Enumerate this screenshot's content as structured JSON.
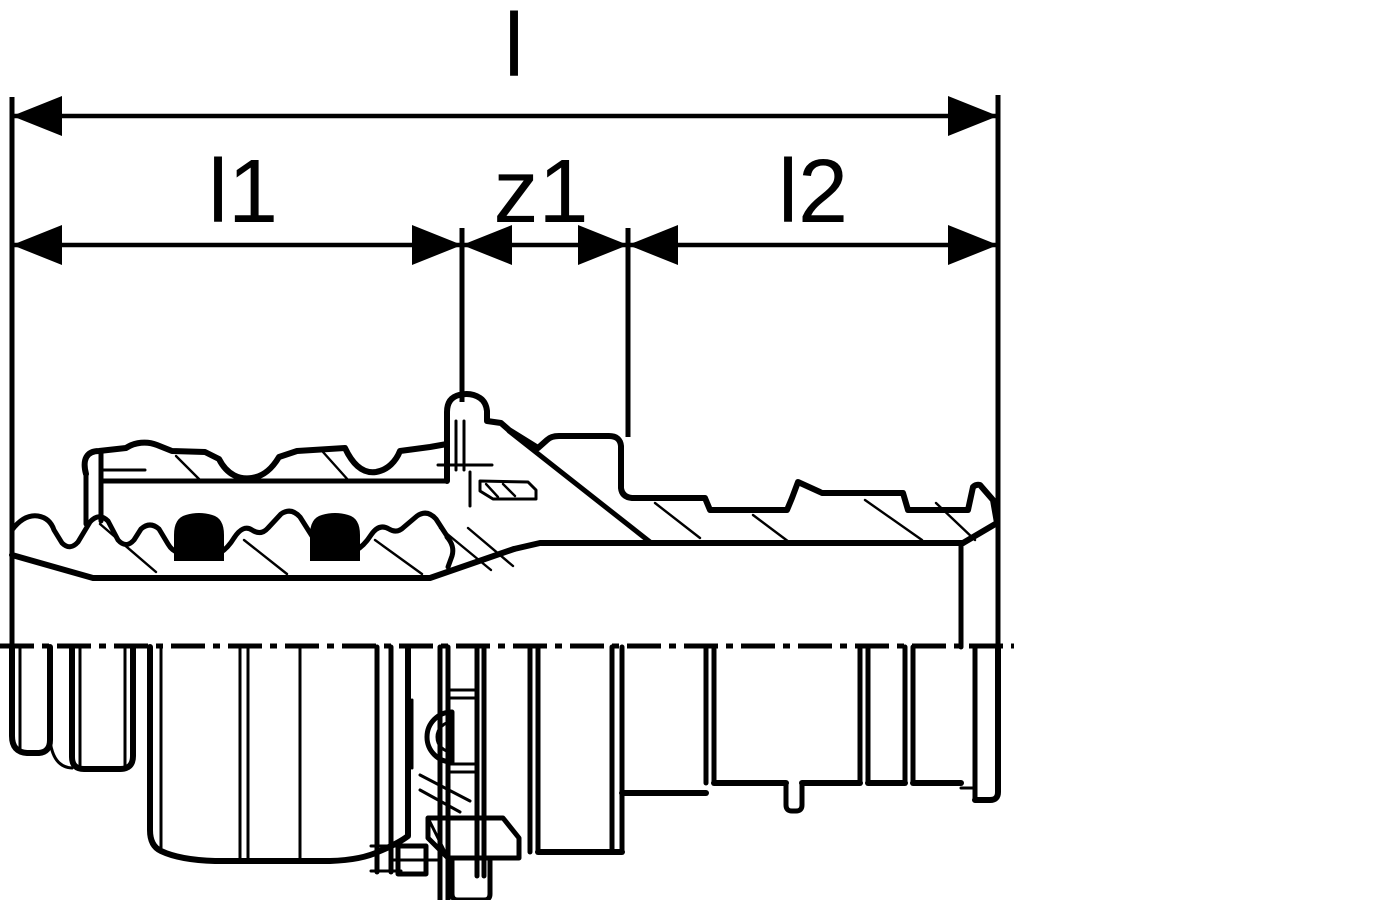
{
  "drawing": {
    "kind": "press-fitting coupling, sectional dimension drawing",
    "dimensions": {
      "overall": {
        "label": "l"
      },
      "left": {
        "label": "l1"
      },
      "offset": {
        "label": "z1"
      },
      "right": {
        "label": "l2"
      }
    },
    "colors": {
      "line": "#000000",
      "background": "#ffffff",
      "seal_fill": "#000000"
    }
  }
}
